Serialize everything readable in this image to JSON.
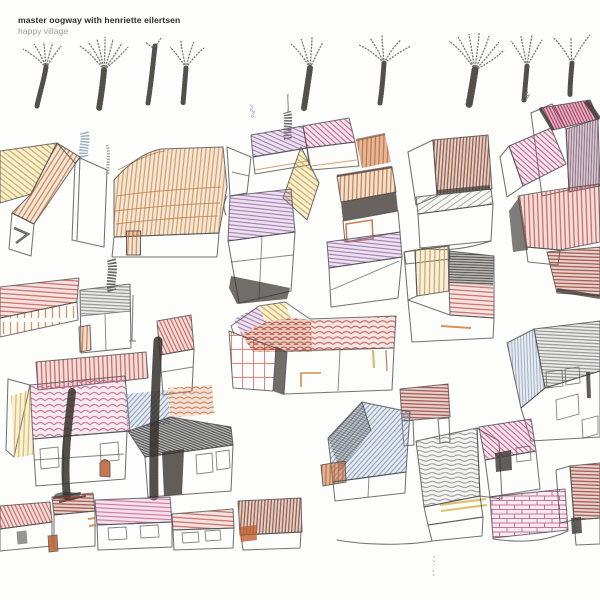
{
  "header": {
    "artist": "master oogway with henriette eilertsen",
    "title": "happy village"
  },
  "palette": {
    "background": "#fdfdfc",
    "pencil_outline": "#4f4f4f",
    "charcoal": "#3a3631",
    "yellow_ochre": "#d4a72c",
    "orange": "#c77b3b",
    "burnt_orange": "#bf5f2e",
    "thatch_tan": "#cf8c45",
    "red": "#c25044",
    "dark_red": "#9a4130",
    "brown_red": "#8f4a32",
    "pink": "#cd6f9d",
    "magenta": "#c2558b",
    "crimson": "#a82a58",
    "purple": "#a172ae",
    "mauve": "#8d6880",
    "blue_gray": "#8094b8",
    "smoke_blue": "#8ba0b5",
    "gray": "#6f6f6f"
  },
  "scene": {
    "kind": "hand-drawn crayon village with bare trees, houses and tree trunks",
    "tree_count": 9
  }
}
